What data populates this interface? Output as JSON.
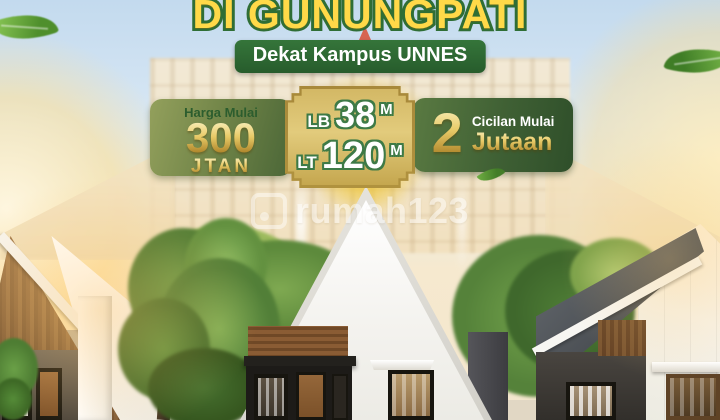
{
  "ad": {
    "headline": "DI GUNUNGPATI",
    "location_badge": "Dekat Kampus UNNES",
    "price": {
      "label": "Harga Mulai",
      "value": "300",
      "unit": "JTAN"
    },
    "specs": {
      "rows": [
        {
          "label": "LB",
          "value": "38",
          "unit": "M"
        },
        {
          "label": "LT",
          "value": "120",
          "unit": "M"
        }
      ]
    },
    "installment": {
      "value": "2",
      "label": "Cicilan Mulai",
      "unit": "Jutaan"
    },
    "watermark": "rumah123"
  },
  "colors": {
    "headline_fill": "#FFD948",
    "headline_outline": "#2F6E35",
    "location_badge_bg": "#2E6B35",
    "badge_olive_green": "#6F8347",
    "badge_dark_green": "#3F6034",
    "plaque_gold": "#DCC372",
    "gold_text": "#E8CA67",
    "spec_text_outline": "#3E7A46",
    "sky_top": "#C3DAEE",
    "sun_glow": "#FFDF91"
  }
}
